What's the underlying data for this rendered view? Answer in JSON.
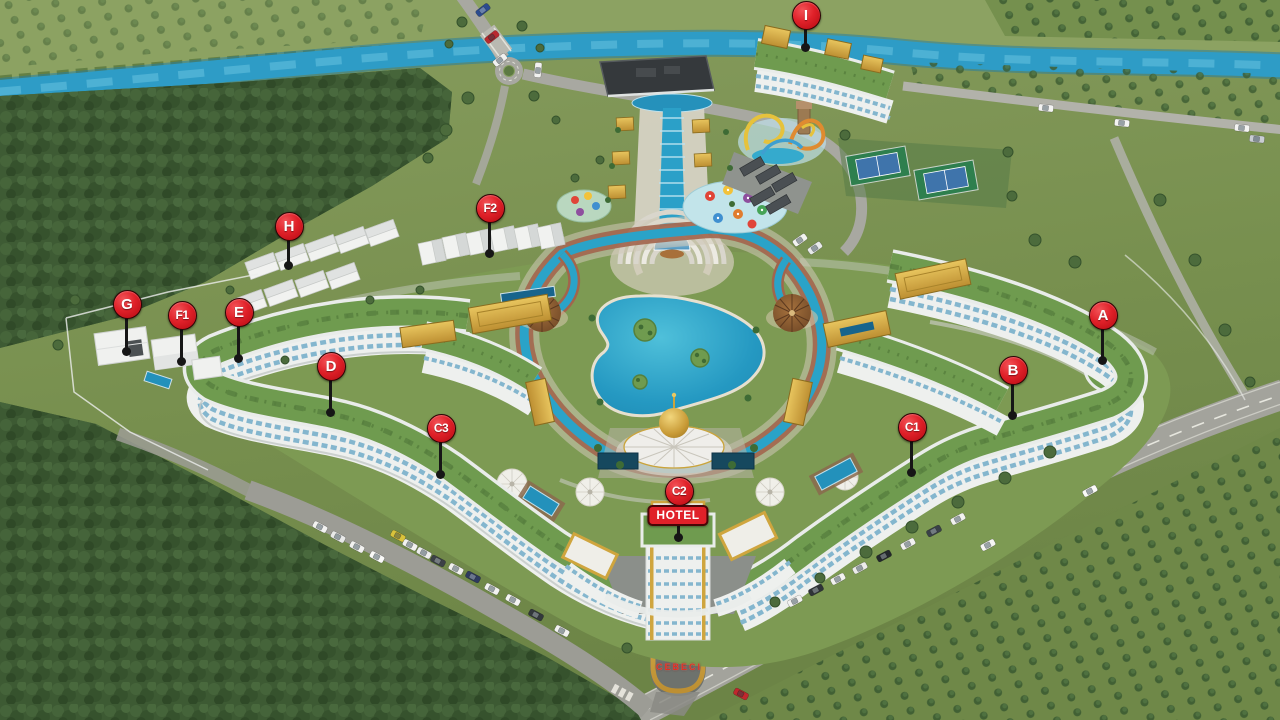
{
  "markers": [
    {
      "id": "a",
      "label": "A",
      "x": 1102,
      "y": 314,
      "stem": 47
    },
    {
      "id": "b",
      "label": "B",
      "x": 1012,
      "y": 369,
      "stem": 47
    },
    {
      "id": "c1",
      "label": "C1",
      "x": 911,
      "y": 426,
      "stem": 47
    },
    {
      "id": "c2",
      "label": "C2",
      "x": 678,
      "y": 490,
      "stem": 48,
      "sublabel": "HOTEL"
    },
    {
      "id": "c3",
      "label": "C3",
      "x": 440,
      "y": 427,
      "stem": 48
    },
    {
      "id": "d",
      "label": "D",
      "x": 330,
      "y": 365,
      "stem": 48
    },
    {
      "id": "e",
      "label": "E",
      "x": 238,
      "y": 311,
      "stem": 48
    },
    {
      "id": "f1",
      "label": "F1",
      "x": 181,
      "y": 314,
      "stem": 48
    },
    {
      "id": "f2",
      "label": "F2",
      "x": 489,
      "y": 207,
      "stem": 47
    },
    {
      "id": "g",
      "label": "G",
      "x": 126,
      "y": 303,
      "stem": 49
    },
    {
      "id": "h",
      "label": "H",
      "x": 288,
      "y": 225,
      "stem": 41
    },
    {
      "id": "i",
      "label": "I",
      "x": 805,
      "y": 14,
      "stem": 34
    }
  ],
  "labels": {
    "entrance_sign": "CEBECI"
  },
  "colors": {
    "pin_red": "#e02129",
    "pin_rim": "#2e0304",
    "pin_stem": "#161616",
    "river": "#2e9cc6",
    "grass": "#7e9455",
    "forest": "#3f5c35",
    "roof_green": "#6f9b4f",
    "building_white": "#eef0ee",
    "window_blue": "#84b6ce",
    "gold": "#d2a23b",
    "pool": "#27a3c9",
    "road": "#a3a39c"
  }
}
